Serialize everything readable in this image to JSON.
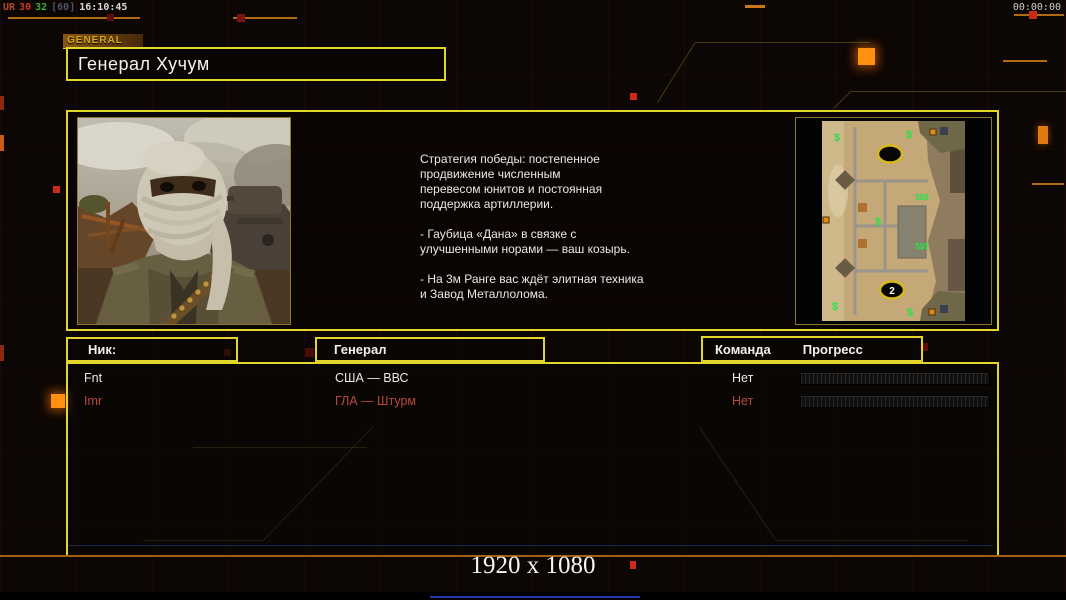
{
  "hud": {
    "perf_label": "UR",
    "perf_v1": "30",
    "perf_v2": "32",
    "perf_cap": "[60]",
    "perf_time": "16:10:45",
    "clock": "00:00:00"
  },
  "tab": {
    "label": "GENERAL"
  },
  "header": {
    "title": "Генерал Хучум"
  },
  "briefing": {
    "text": "Стратегия победы: постепенное\nпродвижение численным\nперевесом юнитов и постоянная\nподдержка артиллерии.\n\n- Гаубица «Дана» в связке с\nулучшенными норами — ваш козырь.\n\n- На 3м Ранге вас ждёт элитная техника\nи Завод Металлолома."
  },
  "minimap": {
    "start_label": "2",
    "supply_icon": "$",
    "supply_cluster": "$$$"
  },
  "table": {
    "headers": {
      "nick": "Ник:",
      "general": "Генерал",
      "team": "Команда",
      "progress": "Прогресс"
    },
    "rows": [
      {
        "nick": "Fnt",
        "general": "США — ВВС",
        "team": "Нет",
        "progress_percent": 0,
        "color": "#e9e9e9"
      },
      {
        "nick": "Imr",
        "general": "ГЛА — Штурм",
        "team": "Нет",
        "progress_percent": 0,
        "color": "#b5493f"
      }
    ]
  },
  "footer": {
    "resolution": "1920 x 1080"
  },
  "colors": {
    "accent_yellow": "#e3d62b",
    "accent_orange": "#b06a14",
    "alert_red": "#cc2a1a",
    "team_red": "#b5493f"
  }
}
